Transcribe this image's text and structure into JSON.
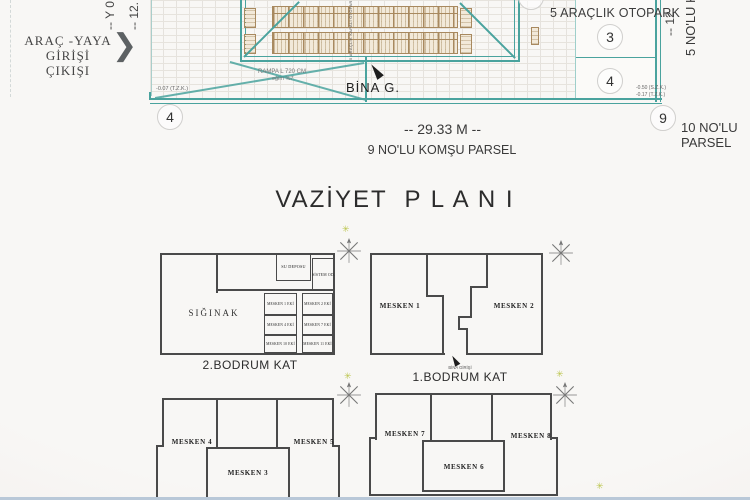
{
  "colors": {
    "teal": "#4aa39e",
    "line": "#4a4a4a",
    "tan": "#a8895f",
    "tanfill": "#f2e9d9",
    "star": "#bcc64f",
    "bg": "#f8f7f5"
  },
  "icons": {
    "entrance_chevron": "❯",
    "north_star": "✳"
  },
  "site": {
    "entrance_line_1": "ARAÇ -YAYA",
    "entrance_line_2": "GİRİŞİ",
    "entrance_line_3": "ÇIKIŞI",
    "otopark": "5 ARAÇLIK OTOPARK",
    "bina_g": "BİNA G.",
    "ramp_line_1": "RAMPA L 720 CM",
    "ramp_line_2": "eğim %7",
    "elev_left": "-0.07 (T.Z.K.)",
    "elev_right_1": "-0.50 (S.Z.K.)",
    "elev_right_2": "-0.17 (T.Z.K.)",
    "dim_bottom": "-- 29.33 M --",
    "parcel_bottom": "9 NO'LU KOMŞU PARSEL",
    "parcel_right_line_1": "10 NO'LU",
    "parcel_right_line_2": "PARSEL",
    "rot_left_1": "-- Y 0",
    "rot_left_2": "-- 12.",
    "rot_right_dim": "-- 12.",
    "rot_right_parcel": "5 NO'LU KOM",
    "building_center_label": "5 ARAÇLIK KAPALI OTOPARK",
    "marker_left": "4",
    "marker_stall_top": "3",
    "marker_stall_bottom": "4",
    "marker_right": "9"
  },
  "title": "VAZİYET  P L A N I",
  "plans": {
    "a": {
      "caption": "2.BODRUM KAT",
      "siginak": "SIĞINAK",
      "su_deposu": "SU DEPOSU",
      "sistem_od": "SİSTEM OD.",
      "cells_left": [
        "MESKEN 1 EKİ",
        "MESKEN 4 EKİ",
        "MESKEN 10 EKİ"
      ],
      "cells_right": [
        "MESKEN 2 EKİ",
        "MESKEN 7 EKİ",
        "MESKEN 11 EKİ"
      ]
    },
    "b": {
      "caption": "1.BODRUM KAT",
      "entrance": "BİNA GİRİŞİ",
      "m1": "MESKEN 1",
      "m2": "MESKEN 2"
    },
    "c": {
      "m3": "MESKEN 3",
      "m4": "MESKEN 4",
      "m5": "MESKEN 5"
    },
    "d": {
      "m6": "MESKEN 6",
      "m7": "MESKEN 7",
      "m8": "MESKEN 8"
    }
  }
}
